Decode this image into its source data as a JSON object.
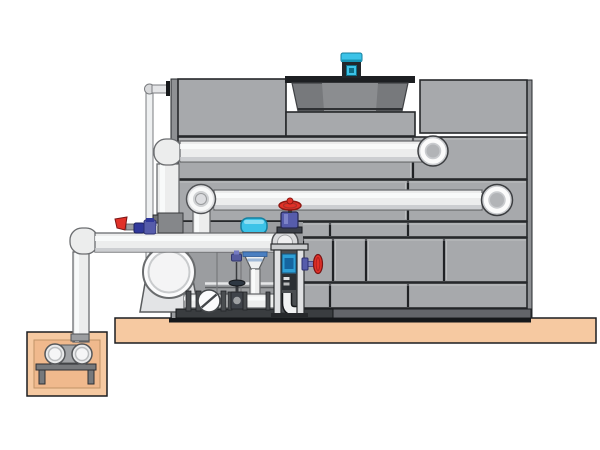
{
  "scene": {
    "type": "technical-illustration",
    "description": "Closed-circuit cooling tower with top fan motor, external supply and return piping, front pump-and-valve skid, and a below-grade sump pump pit set into a concrete slab",
    "background": "#ffffff"
  },
  "colors": {
    "ground_tan": "#f6c9a1",
    "pit_inner_tan": "#f0b98d",
    "panel_gray": "#a7a9ac",
    "cowl_gray": "#77797c",
    "base_dark": "#63656a",
    "outline_black": "#16181b",
    "pipe_white": "#eceded",
    "accent_cyan": "#3cc3e8",
    "motor_dark": "#23272b",
    "valve_red": "#e13128",
    "valve_blue": "#565cab",
    "pump_blue": "#2e9fd6",
    "frame_gray": "#e0e1e3"
  },
  "components": {
    "ground_slab": "Concrete ground slab",
    "sump_pit": "Below-grade sump pit",
    "sump_pump": "Sump transfer pump on stand",
    "riser_pipe": "Sump riser pipe",
    "cooling_tower": "Cooling tower panel cabinet",
    "fan_assembly": "Fan cowl on tower deck",
    "fan_motor": "Cyan fan motor",
    "overflow_pipe": "Thin overflow pipe",
    "skid_enclosure": "Pump skid enclosure",
    "return_pipe": "Lower return pipe with flanged elbows",
    "supply_pipe": "Upper supply pipe with flanged elbows",
    "main_pump": "Centrifugal pump with round inlet",
    "skid_base": "Skid base channel",
    "actuator_dome": "Cyan control-valve actuator dome",
    "suction_manifold": "Suction manifold pipe from sump",
    "manifold_fittings": "Drain lever and isolation valves on manifold",
    "control_valve": "Vertical control valve with funnel body",
    "pipe_train": "Skid pipe train",
    "check_valve": "Swing check valve",
    "gate_valve": "Gate valve with handwheel",
    "filter_frame": "Framed filter / dosing unit",
    "globe_valve": "Globe valve with red handwheel",
    "side_valve": "Side shut-off valve with red wheel"
  }
}
